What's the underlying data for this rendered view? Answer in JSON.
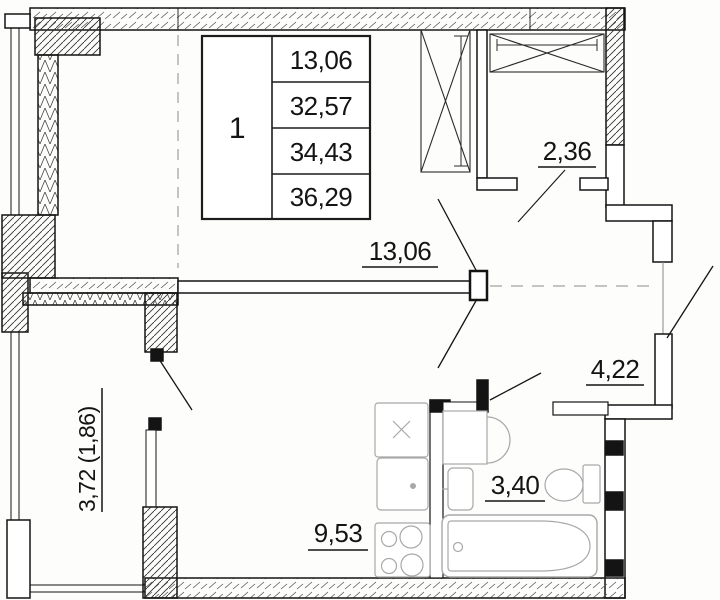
{
  "legend": {
    "unit": "1",
    "areas": [
      "13,06",
      "32,57",
      "34,43",
      "36,29"
    ]
  },
  "rooms": {
    "living": {
      "area": "13,06"
    },
    "wardrobe": {
      "area": "2,36"
    },
    "hall": {
      "area": "4,22"
    },
    "bathroom": {
      "area": "3,40"
    },
    "kitchen": {
      "area": "9,53"
    },
    "balcony": {
      "area": "3,72 (1,86)"
    }
  },
  "colors": {
    "line": "#141414",
    "fixture": "#a8a8a8",
    "hatch": "#444444",
    "background": "#fdfdfc"
  }
}
